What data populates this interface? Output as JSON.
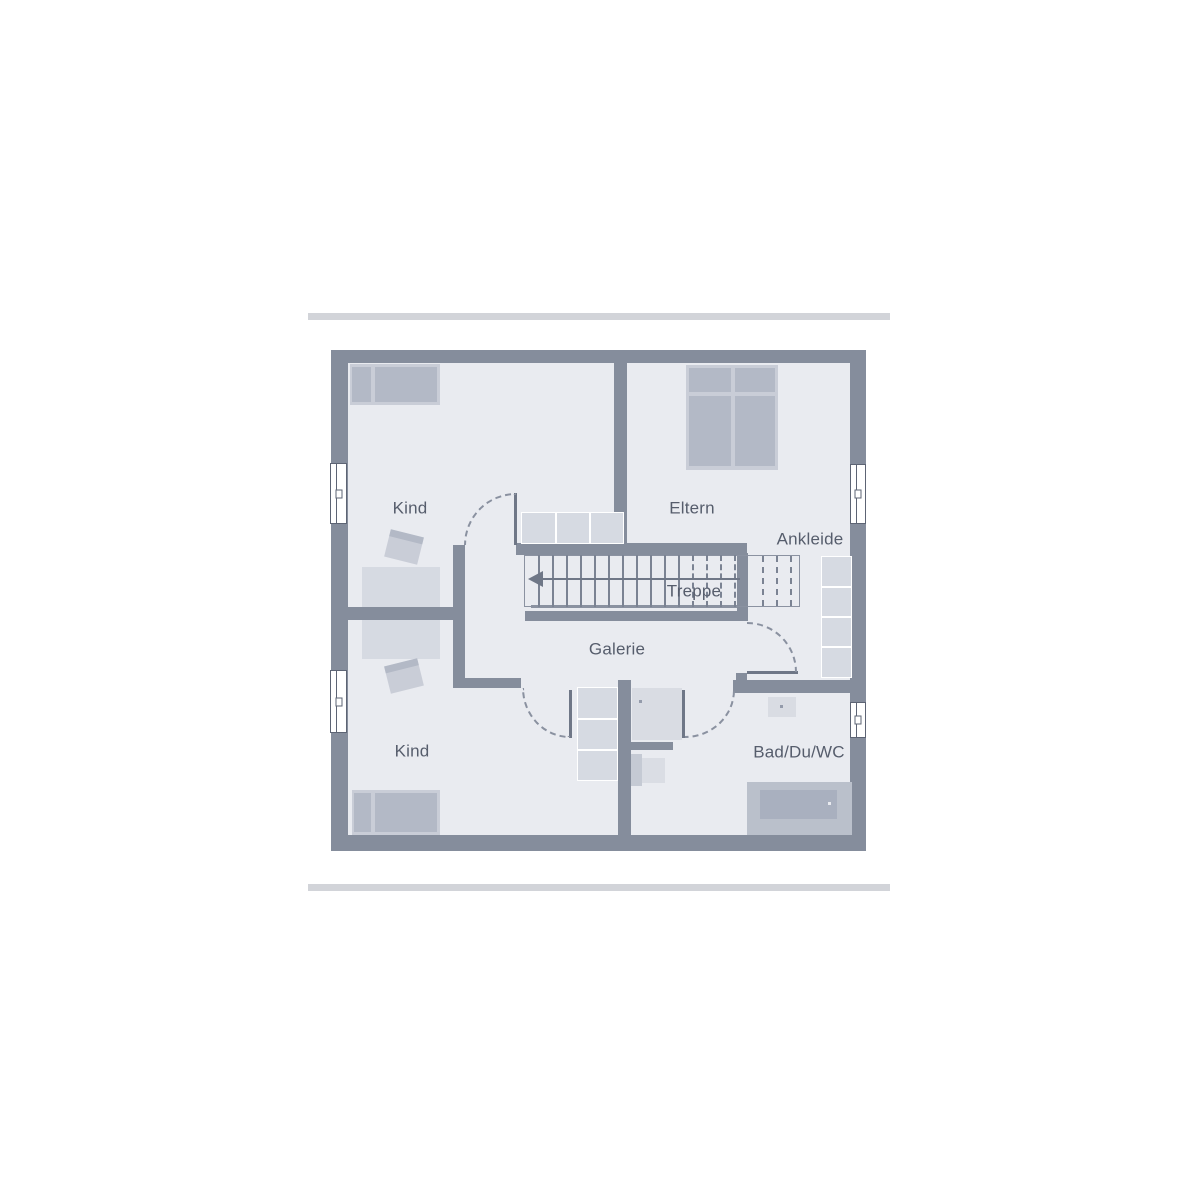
{
  "page": {
    "background": "#ffffff",
    "kind": "floor-plan",
    "floor_shown": "upper-floor"
  },
  "colors": {
    "wall": "#858d9c",
    "room_fill": "#e9ebf0",
    "furniture_light": "#d6dae2",
    "furniture_mid": "#c9cdd7",
    "furniture_dark": "#b3b9c6",
    "stair_line": "#7b8393",
    "arrow": "#6f7787",
    "label_text": "#565d6c",
    "decor_bar": "#d2d4d9",
    "shower_fill": "#d9dce3",
    "window_fill": "#ffffff"
  },
  "labels": {
    "kind_top": "Kind",
    "eltern": "Eltern",
    "ankleide": "Ankleide",
    "treppe": "Treppe",
    "galerie": "Galerie",
    "kind_bottom": "Kind",
    "bad": "Bad/Du/WC"
  },
  "icons": {
    "stair_direction_arrow": "left-arrow",
    "door_swings": "dashed-quarter-circle"
  }
}
